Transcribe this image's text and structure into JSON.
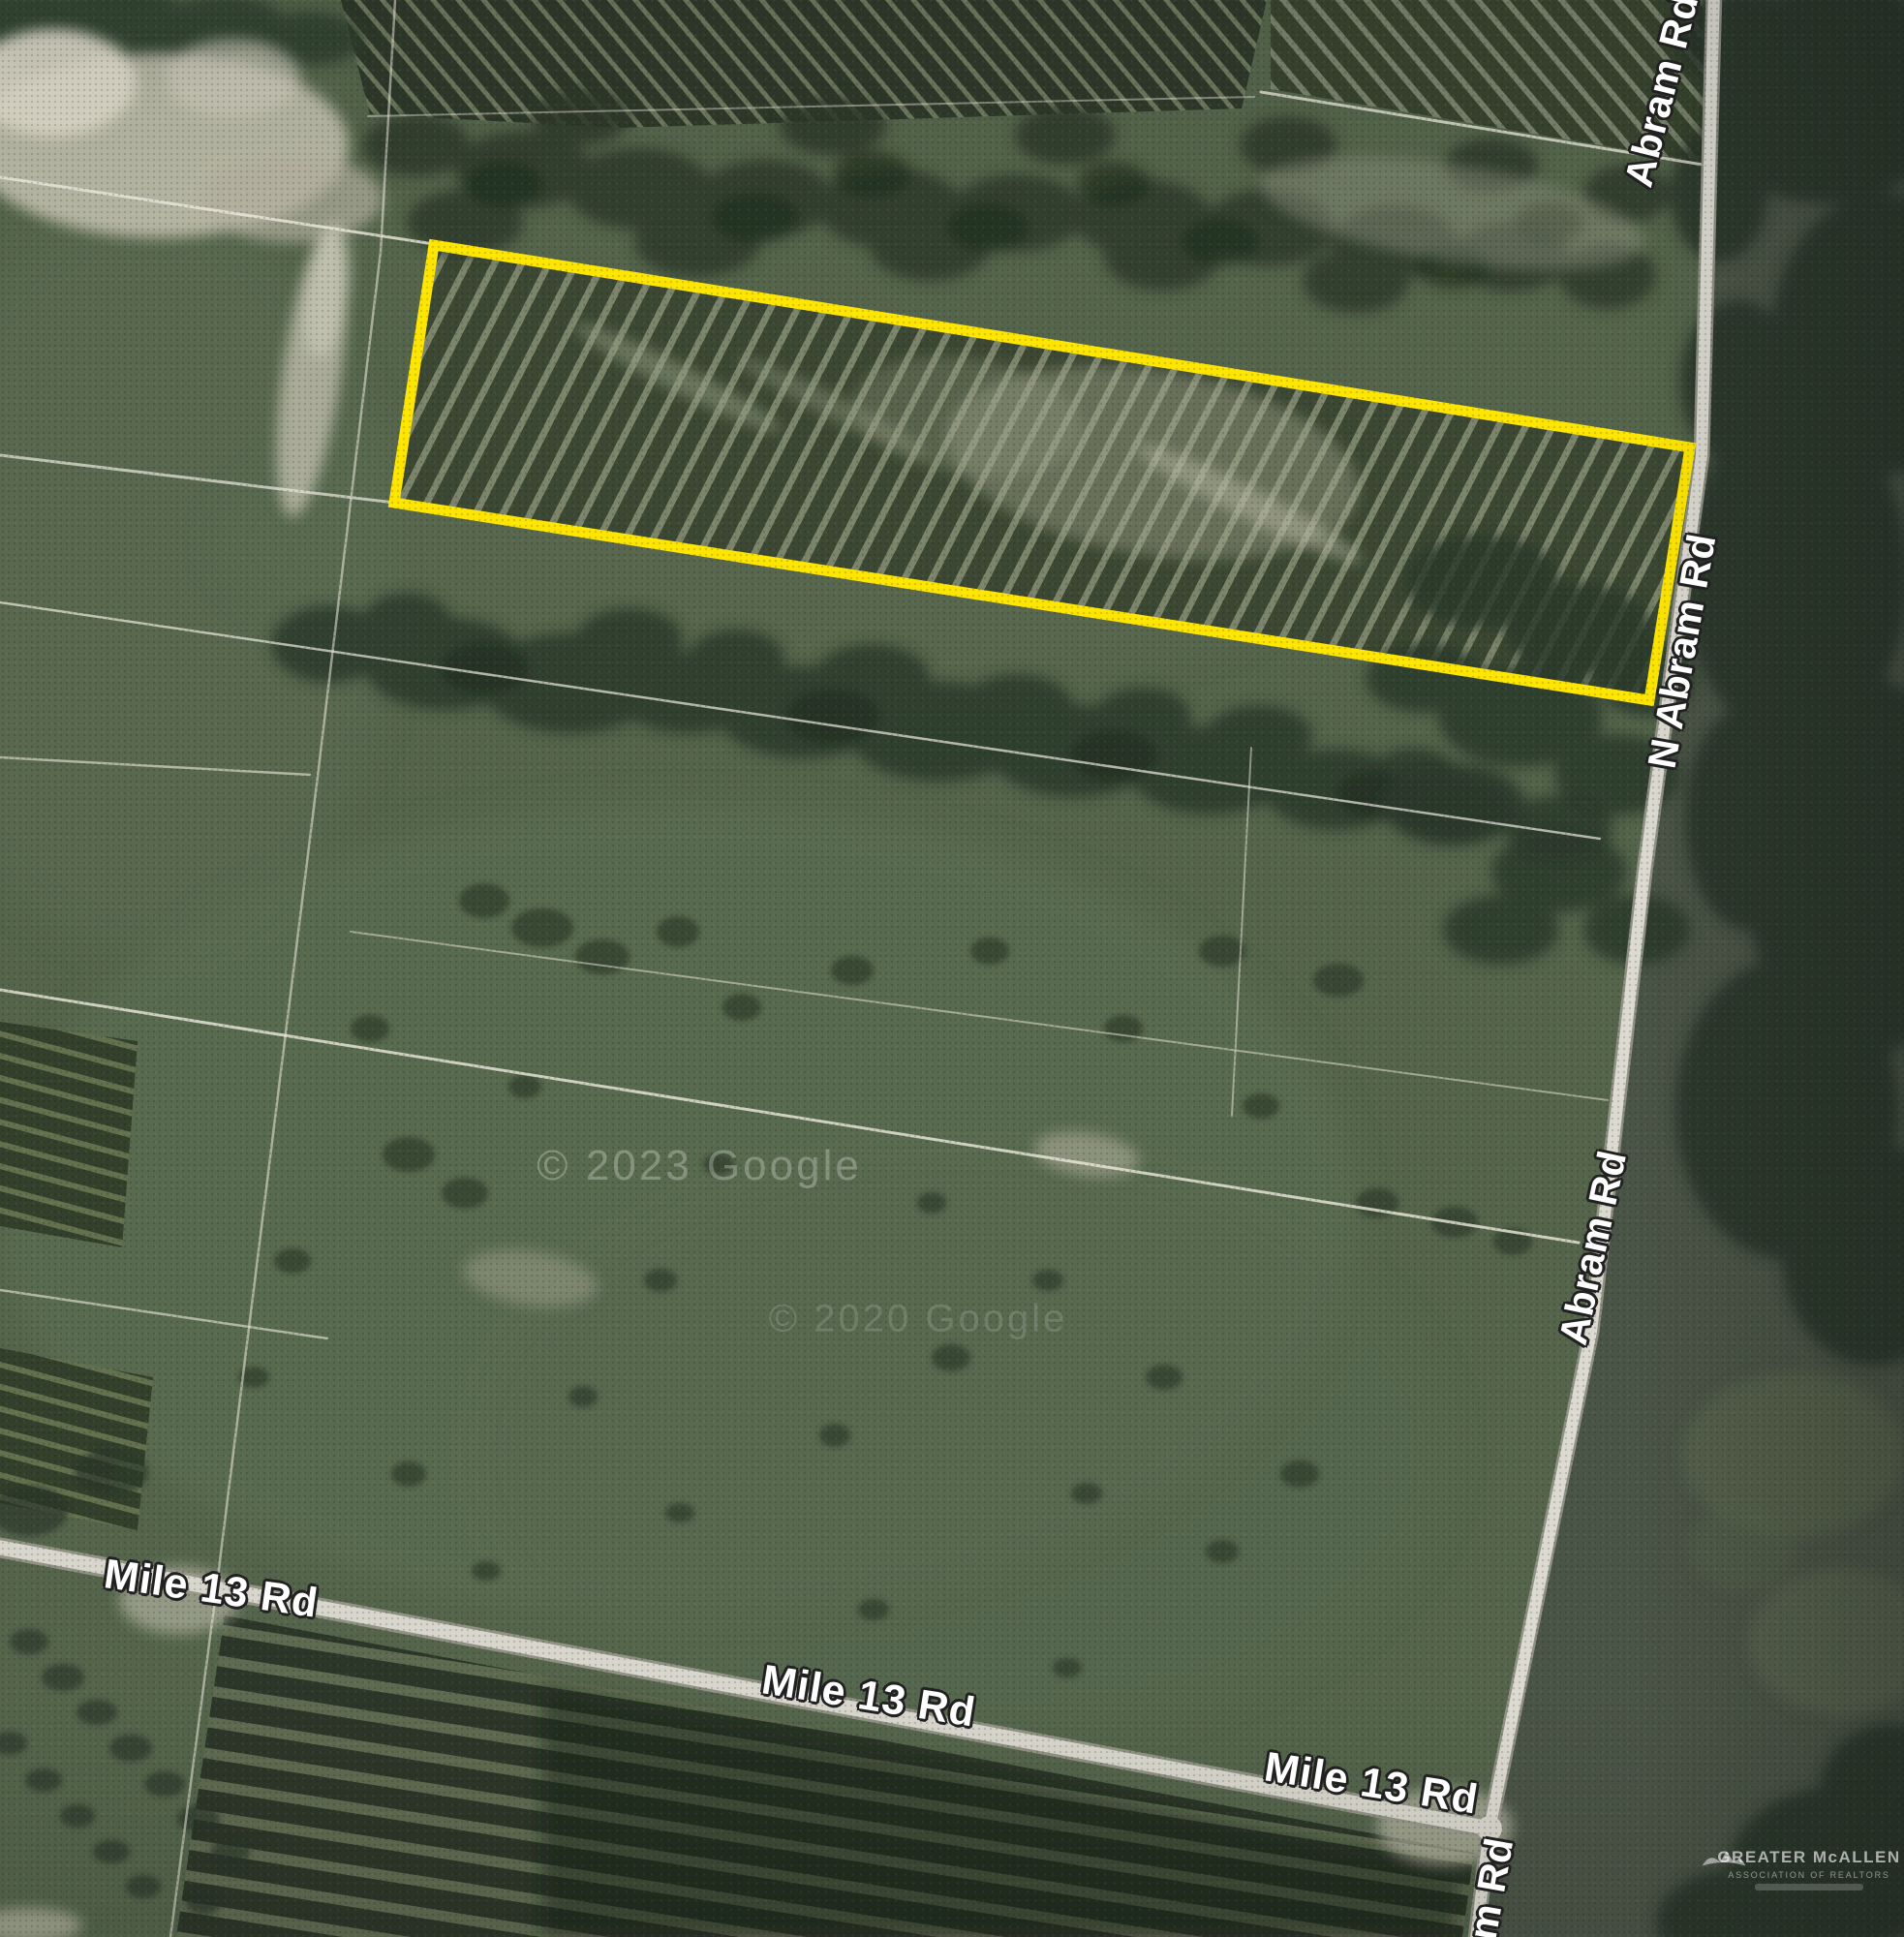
{
  "map": {
    "type": "satellite-aerial-view",
    "road_labels": [
      {
        "text": "Abram Rd"
      },
      {
        "text": "N Abram Rd"
      },
      {
        "text": "Abram Rd"
      },
      {
        "text": "Mile 13 Rd"
      },
      {
        "text": "Mile 13 Rd"
      },
      {
        "text": "Mile 13 Rd"
      },
      {
        "text": "m Rd"
      }
    ],
    "watermarks": [
      {
        "text": "© 2023 Google"
      },
      {
        "text": "© 2020 Google"
      }
    ],
    "attribution_logo": {
      "line1": "GREATER McALLEN",
      "line2": "ASSOCIATION OF REALTORS"
    },
    "parcel": {
      "outline_color": "#FFE600",
      "description": "highlighted property boundary"
    },
    "label_color": "#FFFFFF"
  }
}
